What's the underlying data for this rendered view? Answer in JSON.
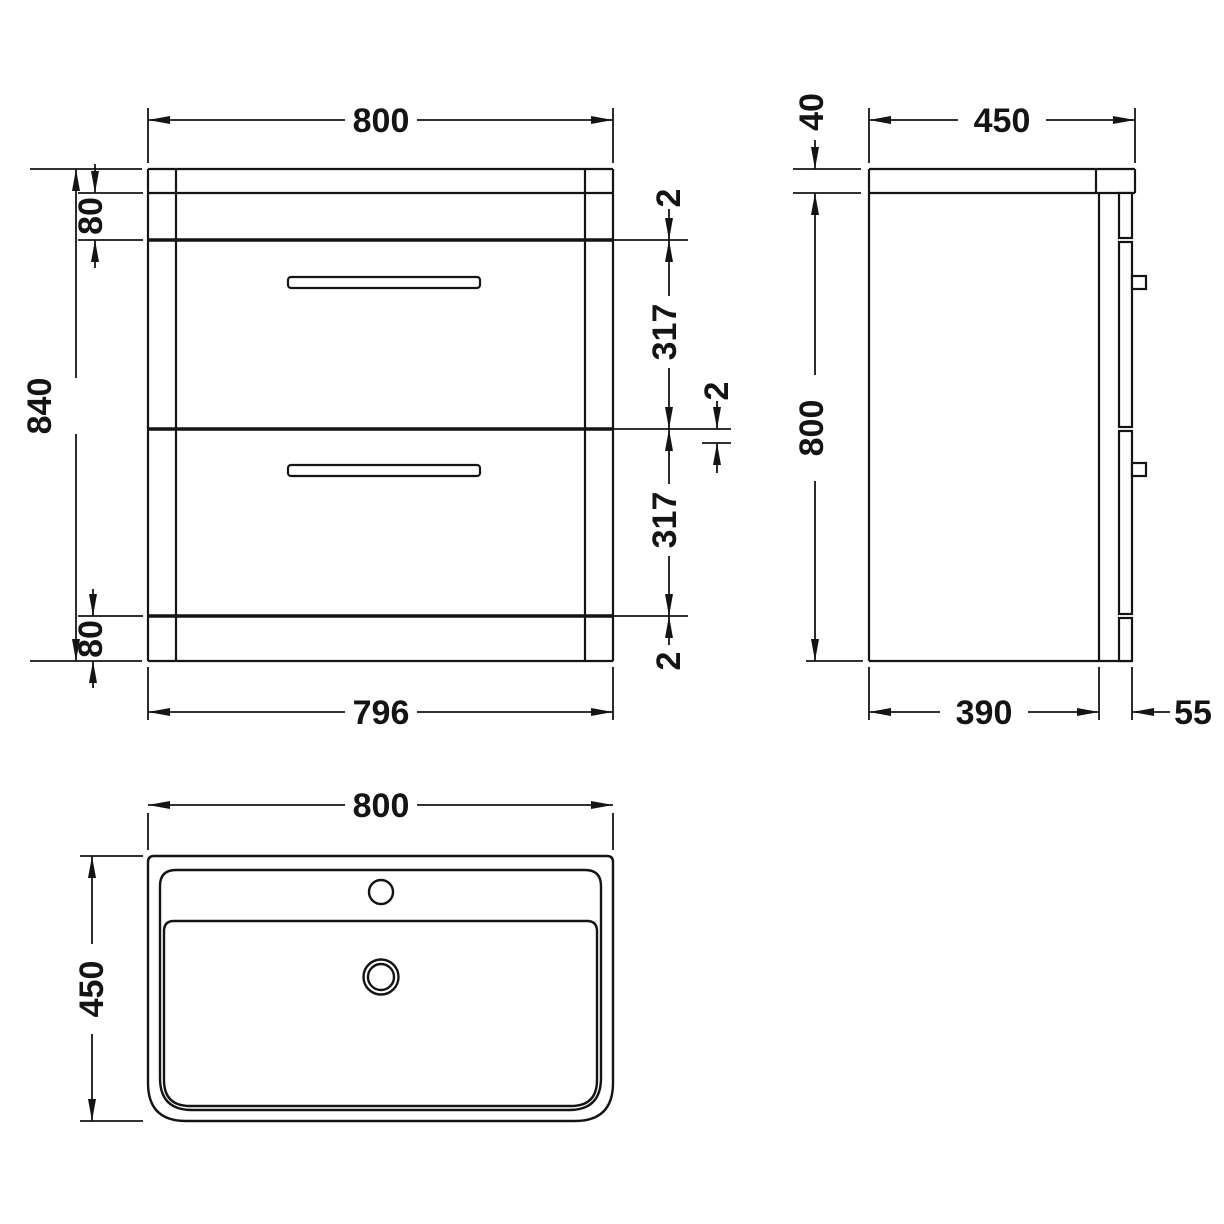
{
  "drawing": {
    "product": "vanity-unit-with-basin-dimension-diagram",
    "colors": {
      "line": "#141414",
      "background": "#ffffff"
    },
    "front": {
      "width_top": "800",
      "overall_height": "840",
      "top_rail": "80",
      "bottom_rail": "80",
      "gap_top": "2",
      "drawer_1_height": "317",
      "gap_middle": "2",
      "drawer_2_height": "317",
      "gap_bottom": "2",
      "width_bottom": "796"
    },
    "side": {
      "worktop_thickness": "40",
      "overall_depth": "450",
      "cabinet_height": "800",
      "carcass_depth": "390",
      "front_panel_depth": "55"
    },
    "plan": {
      "basin_width": "800",
      "basin_depth": "450"
    }
  }
}
